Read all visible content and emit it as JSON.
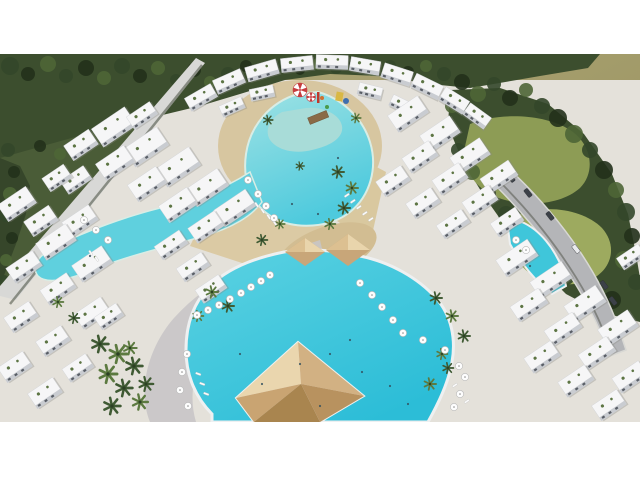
{
  "image": {
    "kind": "aerial 3d architectural rendering",
    "subject": "resort apartment compound with lagoon swimming pools, palm trees, sun umbrellas, surrounded by forest",
    "content_top": 54,
    "content_height": 368
  },
  "palette": {
    "white": "#ffffff",
    "haze": "#a9a274",
    "hazeLight": "#b6ae80",
    "forestBase": "#3c4e2e",
    "outsideGreen": "#4a5c37",
    "treeShades": [
      "#22311b",
      "#33472a",
      "#4e6636",
      "#6f8748"
    ],
    "grass": "#8d9c55",
    "grassLight": "#9daa5f",
    "ground": "#e4e1da",
    "sand": "#d7c6a0",
    "sandDeep": "#d2bd92",
    "plaza": "#c8c5c6",
    "wall": "#d8d8d6",
    "wallShadow": "#3a4232",
    "road": "#b4b5b8",
    "roadEdge": "#d8d8d4",
    "poolDeep": "#2fc0d8",
    "poolMid": "#49cbdf",
    "poolLight": "#8adfe8",
    "poolRim": "#eef0f1",
    "kidsPool": "#a8dcd8",
    "building": "#f6f6f7",
    "buildingEdge": "#d0d2d6",
    "facade": "#c9ccd1",
    "windowDark": "#595e66",
    "blockShadow": "#8a8a84",
    "terraceGreen": "#5d7544",
    "palmDark": "#3f5a33",
    "palmLight": "#5c7a40",
    "palmTrunk": "#2c4024",
    "pyramidTopFace": "#ead6ae",
    "pyramidEastFace": "#d2b183",
    "pyramidSouthFace": "#b8925f",
    "pyramidWestFace": "#c9a472",
    "umbrellaWhite": "#fdfdfd",
    "umbrellaRing": "#b9b9b9",
    "umbrellaDot": "#8a8a8a",
    "loungerWhite": "#fafafa",
    "carDark": "#3c4148",
    "carLight": "#e9eaec",
    "canopyRed": "#c63c3e",
    "slideYellow": "#d9b844",
    "slideBlue": "#3e6fae",
    "slideRed": "#c0392b",
    "slideGreen": "#4a9a4a",
    "slideOrange": "#d07030",
    "bridgeWood": "#8a6a46",
    "swimmer": "#33505e"
  },
  "scene": {
    "treeBlobs": [
      [
        10,
        12,
        9,
        1
      ],
      [
        28,
        20,
        7,
        0
      ],
      [
        48,
        10,
        8,
        2
      ],
      [
        66,
        22,
        7,
        1
      ],
      [
        86,
        14,
        8,
        0
      ],
      [
        104,
        24,
        7,
        2
      ],
      [
        122,
        12,
        8,
        1
      ],
      [
        140,
        22,
        7,
        0
      ],
      [
        158,
        14,
        7,
        2
      ],
      [
        176,
        26,
        6,
        1
      ],
      [
        194,
        16,
        7,
        0
      ],
      [
        210,
        28,
        6,
        2
      ],
      [
        228,
        20,
        7,
        1
      ],
      [
        246,
        12,
        6,
        0
      ],
      [
        264,
        18,
        6,
        2
      ],
      [
        282,
        12,
        6,
        1
      ],
      [
        300,
        16,
        5,
        0
      ],
      [
        318,
        10,
        6,
        2
      ],
      [
        336,
        14,
        6,
        1
      ],
      [
        354,
        10,
        5,
        0
      ],
      [
        372,
        16,
        6,
        2
      ],
      [
        390,
        12,
        6,
        1
      ],
      [
        408,
        18,
        6,
        0
      ],
      [
        426,
        12,
        6,
        2
      ],
      [
        444,
        20,
        7,
        1
      ],
      [
        462,
        28,
        8,
        0
      ],
      [
        478,
        40,
        8,
        2
      ],
      [
        494,
        30,
        7,
        1
      ],
      [
        510,
        44,
        8,
        0
      ],
      [
        526,
        36,
        7,
        2
      ],
      [
        542,
        52,
        8,
        1
      ],
      [
        558,
        64,
        9,
        0
      ],
      [
        574,
        80,
        9,
        2
      ],
      [
        590,
        96,
        8,
        1
      ],
      [
        604,
        116,
        9,
        0
      ],
      [
        616,
        136,
        8,
        2
      ],
      [
        626,
        158,
        9,
        1
      ],
      [
        632,
        182,
        8,
        0
      ],
      [
        624,
        206,
        9,
        2
      ],
      [
        636,
        228,
        8,
        1
      ],
      [
        612,
        246,
        9,
        0
      ],
      [
        590,
        238,
        8,
        2
      ],
      [
        566,
        222,
        9,
        1
      ],
      [
        544,
        200,
        8,
        0
      ],
      [
        524,
        180,
        8,
        2
      ],
      [
        506,
        160,
        8,
        1
      ],
      [
        488,
        140,
        8,
        0
      ],
      [
        472,
        118,
        8,
        2
      ],
      [
        458,
        96,
        7,
        1
      ],
      [
        448,
        74,
        7,
        0
      ],
      [
        452,
        52,
        7,
        2
      ],
      [
        8,
        96,
        7,
        1
      ],
      [
        14,
        118,
        6,
        0
      ],
      [
        10,
        140,
        7,
        2
      ],
      [
        6,
        162,
        6,
        1
      ],
      [
        12,
        184,
        6,
        0
      ],
      [
        6,
        206,
        6,
        2
      ],
      [
        4,
        226,
        5,
        1
      ],
      [
        60,
        100,
        6,
        2
      ],
      [
        40,
        92,
        6,
        0
      ]
    ],
    "buildings": [
      [
        186,
        36,
        30,
        15,
        -30
      ],
      [
        214,
        20,
        30,
        15,
        -24
      ],
      [
        246,
        9,
        32,
        15,
        -16
      ],
      [
        281,
        3,
        32,
        14,
        -6
      ],
      [
        316,
        1,
        32,
        14,
        2
      ],
      [
        350,
        5,
        30,
        14,
        10
      ],
      [
        382,
        13,
        30,
        15,
        18
      ],
      [
        412,
        25,
        30,
        15,
        26
      ],
      [
        440,
        39,
        28,
        15,
        32
      ],
      [
        464,
        55,
        26,
        14,
        36
      ],
      [
        220,
        47,
        24,
        12,
        -24
      ],
      [
        250,
        33,
        24,
        12,
        -12
      ],
      [
        358,
        31,
        24,
        12,
        14
      ],
      [
        390,
        45,
        24,
        12,
        26
      ],
      [
        94,
        62,
        40,
        22,
        -34
      ],
      [
        126,
        82,
        40,
        22,
        -34
      ],
      [
        158,
        102,
        40,
        22,
        -34
      ],
      [
        188,
        123,
        38,
        21,
        -34
      ],
      [
        216,
        144,
        38,
        20,
        -34
      ],
      [
        128,
        54,
        28,
        15,
        -34
      ],
      [
        66,
        82,
        30,
        18,
        -34
      ],
      [
        98,
        99,
        34,
        20,
        -34
      ],
      [
        130,
        120,
        34,
        20,
        -34
      ],
      [
        161,
        141,
        34,
        20,
        -34
      ],
      [
        190,
        164,
        32,
        18,
        -34
      ],
      [
        62,
        118,
        28,
        16,
        -34
      ],
      [
        44,
        116,
        26,
        16,
        -34
      ],
      [
        156,
        183,
        30,
        16,
        -34
      ],
      [
        178,
        205,
        30,
        16,
        -34
      ],
      [
        197,
        227,
        28,
        16,
        -34
      ],
      [
        0,
        140,
        34,
        20,
        -34
      ],
      [
        26,
        158,
        30,
        18,
        -34
      ],
      [
        64,
        158,
        32,
        18,
        -34
      ],
      [
        38,
        178,
        36,
        20,
        -34
      ],
      [
        74,
        200,
        36,
        20,
        -34
      ],
      [
        8,
        204,
        32,
        18,
        -34
      ],
      [
        42,
        226,
        32,
        18,
        -34
      ],
      [
        76,
        250,
        32,
        18,
        -34
      ],
      [
        6,
        254,
        30,
        18,
        -34
      ],
      [
        38,
        278,
        30,
        18,
        -34
      ],
      [
        0,
        304,
        30,
        18,
        -34
      ],
      [
        30,
        330,
        30,
        18,
        -34
      ],
      [
        64,
        306,
        28,
        16,
        -34
      ],
      [
        96,
        255,
        26,
        15,
        -34
      ],
      [
        390,
        50,
        36,
        20,
        -34
      ],
      [
        422,
        70,
        36,
        20,
        -34
      ],
      [
        452,
        92,
        36,
        20,
        -34
      ],
      [
        482,
        114,
        34,
        18,
        -34
      ],
      [
        404,
        94,
        32,
        18,
        -34
      ],
      [
        434,
        116,
        32,
        18,
        -34
      ],
      [
        464,
        138,
        32,
        18,
        -34
      ],
      [
        492,
        160,
        30,
        16,
        -34
      ],
      [
        378,
        118,
        30,
        18,
        -34
      ],
      [
        408,
        140,
        30,
        18,
        -34
      ],
      [
        438,
        162,
        30,
        16,
        -34
      ],
      [
        498,
        194,
        38,
        20,
        -34
      ],
      [
        532,
        216,
        38,
        20,
        -34
      ],
      [
        566,
        240,
        38,
        20,
        -34
      ],
      [
        600,
        264,
        36,
        20,
        -34
      ],
      [
        512,
        242,
        34,
        18,
        -34
      ],
      [
        546,
        266,
        34,
        18,
        -34
      ],
      [
        580,
        290,
        34,
        18,
        -34
      ],
      [
        614,
        314,
        32,
        18,
        -34
      ],
      [
        526,
        294,
        32,
        18,
        -34
      ],
      [
        560,
        318,
        32,
        18,
        -34
      ],
      [
        594,
        342,
        30,
        18,
        -34
      ],
      [
        618,
        196,
        26,
        14,
        -34
      ]
    ],
    "palms": [
      [
        100,
        290,
        1.4,
        0
      ],
      [
        118,
        300,
        1.5,
        1
      ],
      [
        134,
        312,
        1.4,
        0
      ],
      [
        108,
        320,
        1.5,
        1
      ],
      [
        124,
        334,
        1.4,
        0
      ],
      [
        140,
        348,
        1.3,
        1
      ],
      [
        112,
        352,
        1.4,
        0
      ],
      [
        130,
        294,
        1.1,
        1
      ],
      [
        146,
        330,
        1.2,
        0
      ],
      [
        212,
        238,
        1.0,
        1
      ],
      [
        228,
        252,
        1.0,
        0
      ],
      [
        198,
        262,
        0.9,
        1
      ],
      [
        338,
        118,
        1.0,
        0
      ],
      [
        352,
        134,
        1.0,
        1
      ],
      [
        344,
        154,
        1.0,
        0
      ],
      [
        330,
        170,
        0.9,
        1
      ],
      [
        262,
        186,
        0.9,
        0
      ],
      [
        280,
        170,
        0.8,
        1
      ],
      [
        436,
        244,
        1.0,
        0
      ],
      [
        452,
        262,
        1.0,
        1
      ],
      [
        464,
        282,
        1.0,
        0
      ],
      [
        442,
        300,
        0.9,
        1
      ],
      [
        268,
        66,
        0.8,
        0
      ],
      [
        356,
        64,
        0.8,
        1
      ],
      [
        300,
        112,
        0.7,
        0
      ],
      [
        430,
        330,
        1.0,
        1
      ],
      [
        448,
        314,
        0.9,
        0
      ],
      [
        58,
        248,
        0.9,
        1
      ],
      [
        74,
        264,
        0.9,
        0
      ]
    ],
    "umbrellas": [
      [
        197,
        261
      ],
      [
        208,
        256
      ],
      [
        219,
        251
      ],
      [
        230,
        245
      ],
      [
        241,
        239
      ],
      [
        251,
        233
      ],
      [
        261,
        227
      ],
      [
        270,
        221
      ],
      [
        187,
        300
      ],
      [
        182,
        318
      ],
      [
        180,
        336
      ],
      [
        188,
        352
      ],
      [
        360,
        229
      ],
      [
        372,
        241
      ],
      [
        382,
        253
      ],
      [
        393,
        266
      ],
      [
        403,
        279
      ],
      [
        423,
        286
      ],
      [
        445,
        296
      ],
      [
        459,
        312
      ],
      [
        465,
        323
      ],
      [
        460,
        340
      ],
      [
        454,
        353
      ],
      [
        516,
        186
      ],
      [
        526,
        196
      ],
      [
        96,
        176
      ],
      [
        108,
        186
      ],
      [
        84,
        166
      ],
      [
        258,
        140
      ],
      [
        266,
        152
      ],
      [
        274,
        164
      ],
      [
        248,
        126
      ]
    ],
    "redCanopies": [
      [
        300,
        36,
        7
      ],
      [
        311,
        43,
        4.5
      ]
    ],
    "loungers": [
      [
        344,
        142,
        -34
      ],
      [
        350,
        148,
        -34
      ],
      [
        356,
        154,
        -34
      ],
      [
        362,
        160,
        -34
      ],
      [
        368,
        166,
        -34
      ],
      [
        256,
        148,
        56
      ],
      [
        262,
        154,
        56
      ],
      [
        268,
        160,
        56
      ],
      [
        274,
        166,
        56
      ],
      [
        196,
        318,
        20
      ],
      [
        200,
        328,
        20
      ],
      [
        204,
        338,
        20
      ],
      [
        452,
        332,
        -34
      ],
      [
        458,
        340,
        -34
      ],
      [
        464,
        348,
        -34
      ],
      [
        90,
        196,
        56
      ],
      [
        96,
        202,
        56
      ]
    ],
    "cars": [
      [
        510,
        119,
        52,
        "dark"
      ],
      [
        527,
        134,
        52,
        "dark"
      ],
      [
        549,
        157,
        52,
        "dark"
      ],
      [
        575,
        190,
        52,
        "light"
      ],
      [
        603,
        226,
        52,
        "dark"
      ],
      [
        612,
        242,
        52,
        "dark"
      ]
    ],
    "swimmers": [
      [
        300,
        310
      ],
      [
        330,
        300
      ],
      [
        362,
        318
      ],
      [
        390,
        332
      ],
      [
        262,
        330
      ],
      [
        320,
        352
      ],
      [
        408,
        350
      ],
      [
        292,
        150
      ],
      [
        318,
        160
      ],
      [
        338,
        104
      ],
      [
        90,
        202
      ],
      [
        530,
        212
      ],
      [
        350,
        286
      ],
      [
        240,
        300
      ]
    ]
  }
}
